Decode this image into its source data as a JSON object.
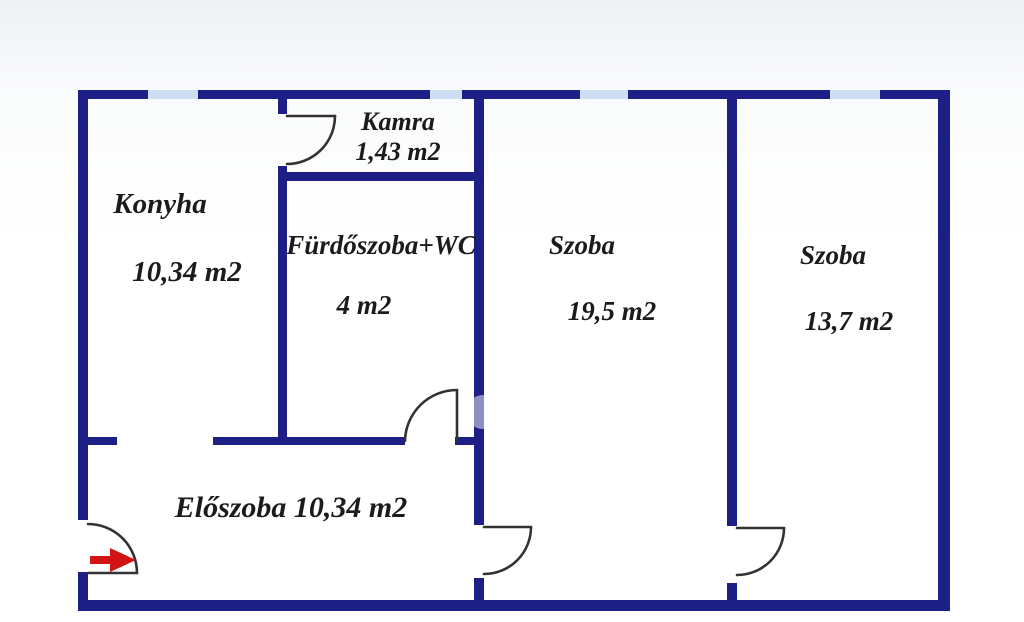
{
  "plan": {
    "title": "Apartment floor plan",
    "rooms": {
      "konyha": {
        "name": "Konyha",
        "area": "10,34 m2"
      },
      "kamra": {
        "name": "Kamra",
        "area": "1,43 m2"
      },
      "furdoszoba": {
        "name": "Fürdőszoba+WC",
        "area": "4 m2"
      },
      "szoba_1": {
        "name": "Szoba",
        "area": "19,5 m2"
      },
      "szoba_2": {
        "name": "Szoba",
        "area": "13,7 m2"
      },
      "eloszoba": {
        "label": "Előszoba 10,34 m2"
      }
    },
    "colors": {
      "wall": "#1e1e87",
      "window": "#cfdef2",
      "door_line": "#333333",
      "arrow": "#d41414",
      "label": "#1b1b1b",
      "watermark": "#ffffff"
    }
  }
}
